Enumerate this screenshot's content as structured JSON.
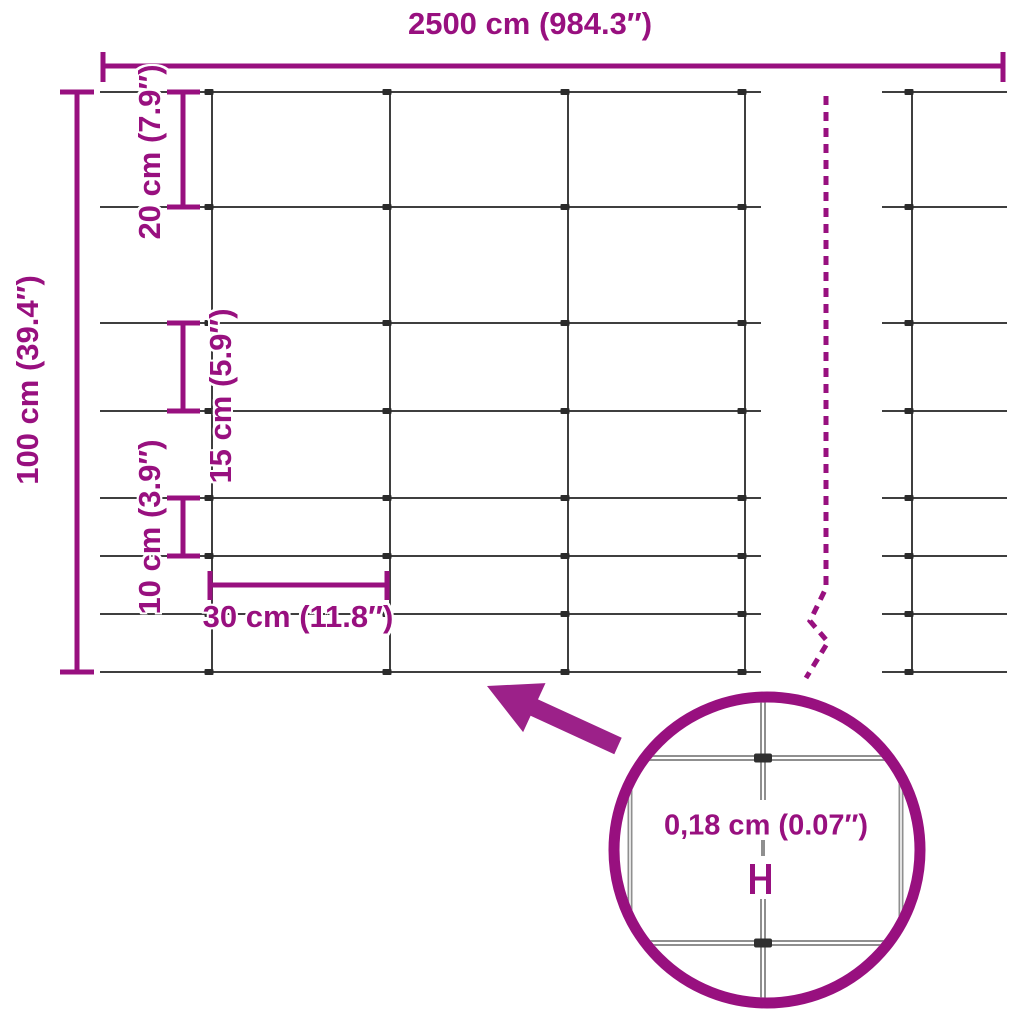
{
  "colors": {
    "accent_purple": "#98107f",
    "arrow_purple": "#9c2189",
    "wire_gray": "#3f3f3f",
    "magnified_wire_gray": "#8f8f8f"
  },
  "dimensions": {
    "total_width": {
      "label": "2500 cm (984.3″)",
      "value_cm": 2500,
      "value_in": 984.3
    },
    "total_height": {
      "label": "100 cm (39.4″)",
      "value_cm": 100,
      "value_in": 39.4
    },
    "top_row_spacing": {
      "label": "20 cm (7.9″)",
      "value_cm": 20,
      "value_in": 7.9
    },
    "middle_row_spacing": {
      "label": "15 cm (5.9″)",
      "value_cm": 15,
      "value_in": 5.9
    },
    "bottom_row_spacing": {
      "label": "10 cm (3.9″)",
      "value_cm": 10,
      "value_in": 3.9
    },
    "column_spacing": {
      "label": "30 cm (11.8″)",
      "value_cm": 30,
      "value_in": 11.8
    },
    "wire_thickness": {
      "label": "0,18 cm (0.07″)",
      "value_cm": 0.18,
      "value_in": 0.07
    }
  },
  "mesh": {
    "horizontal_wire_count": 8,
    "row_spacings_cm": [
      20,
      20,
      15,
      15,
      10,
      10,
      10
    ],
    "column_spacing_cm": 30,
    "wire_diameter_cm": 0.18
  }
}
